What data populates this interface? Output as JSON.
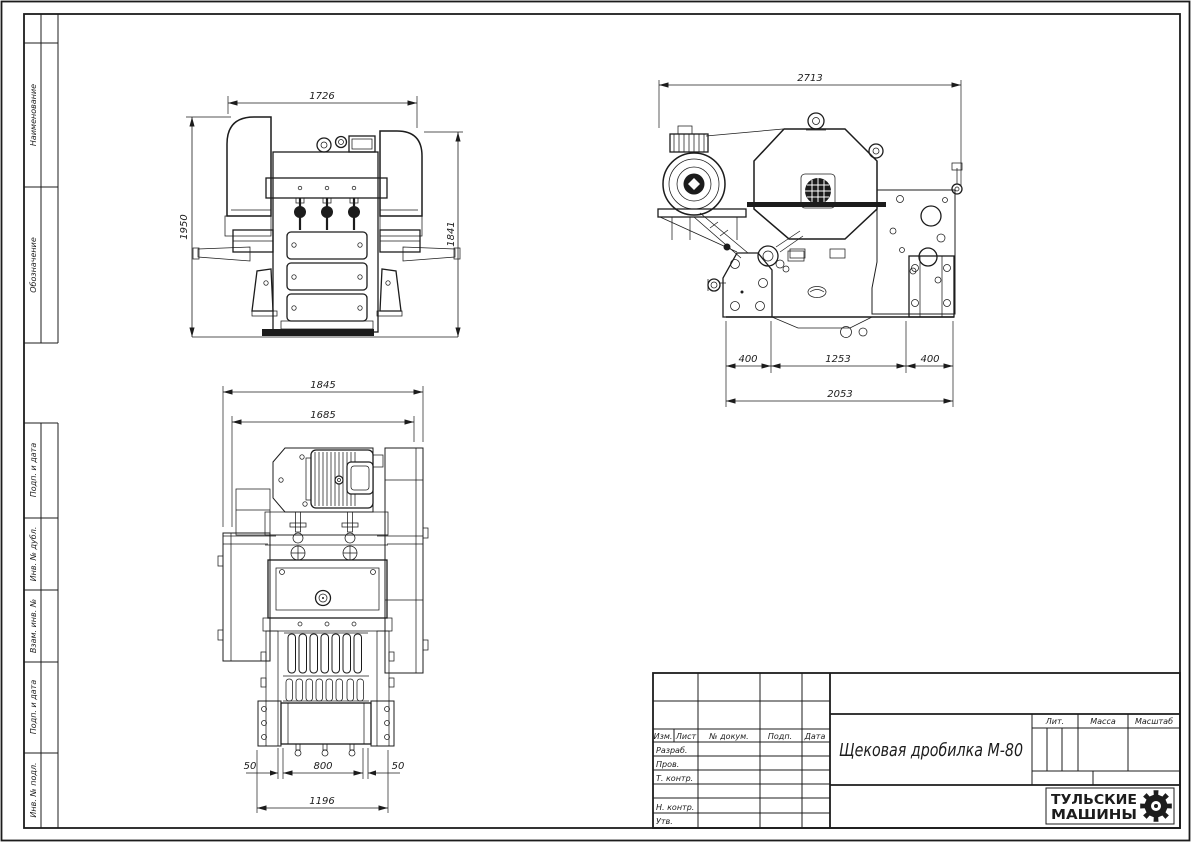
{
  "sheet": {
    "background": "#ffffff",
    "line_color": "#1c1c1c"
  },
  "side_strip": {
    "cell1": "Наименование",
    "cell2": "Обозначение",
    "cell3": "Подп. и дата",
    "cell4": "Инв. № дубл.",
    "cell5": "Взам. инв. №",
    "cell6": "Подп. и дата",
    "cell7": "Инв. № подл."
  },
  "front_view": {
    "dim_width_top": "1726",
    "dim_height_left": "1950",
    "dim_height_right": "1841"
  },
  "side_view": {
    "dim_width_top": "2713",
    "dim_foot_left": "400",
    "dim_center": "1253",
    "dim_foot_right": "400",
    "dim_base_total": "2053"
  },
  "plan_view": {
    "dim_width_outer": "1845",
    "dim_width_inner": "1685",
    "dim_left_offset": "50",
    "dim_jaw_width": "800",
    "dim_right_offset": "50",
    "dim_base_total": "1196"
  },
  "title_block": {
    "header": {
      "izm": "Изм.",
      "list": "Лист",
      "doc_num": "№ докум.",
      "podp": "Подп.",
      "data": "Дата"
    },
    "rows": {
      "razrab": "Разраб.",
      "prov": "Пров.",
      "t_kontr": "Т. контр.",
      "n_kontr": "Н. контр.",
      "utv": "Утв."
    },
    "doc_title": "Щековая дробилка М-80",
    "props": {
      "lit": "Лит.",
      "massa": "Масса",
      "masshtab": "Масштаб"
    },
    "company": {
      "name_line1": "ТУЛЬСКИЕ",
      "name_line2": "МАШИНЫ"
    }
  }
}
